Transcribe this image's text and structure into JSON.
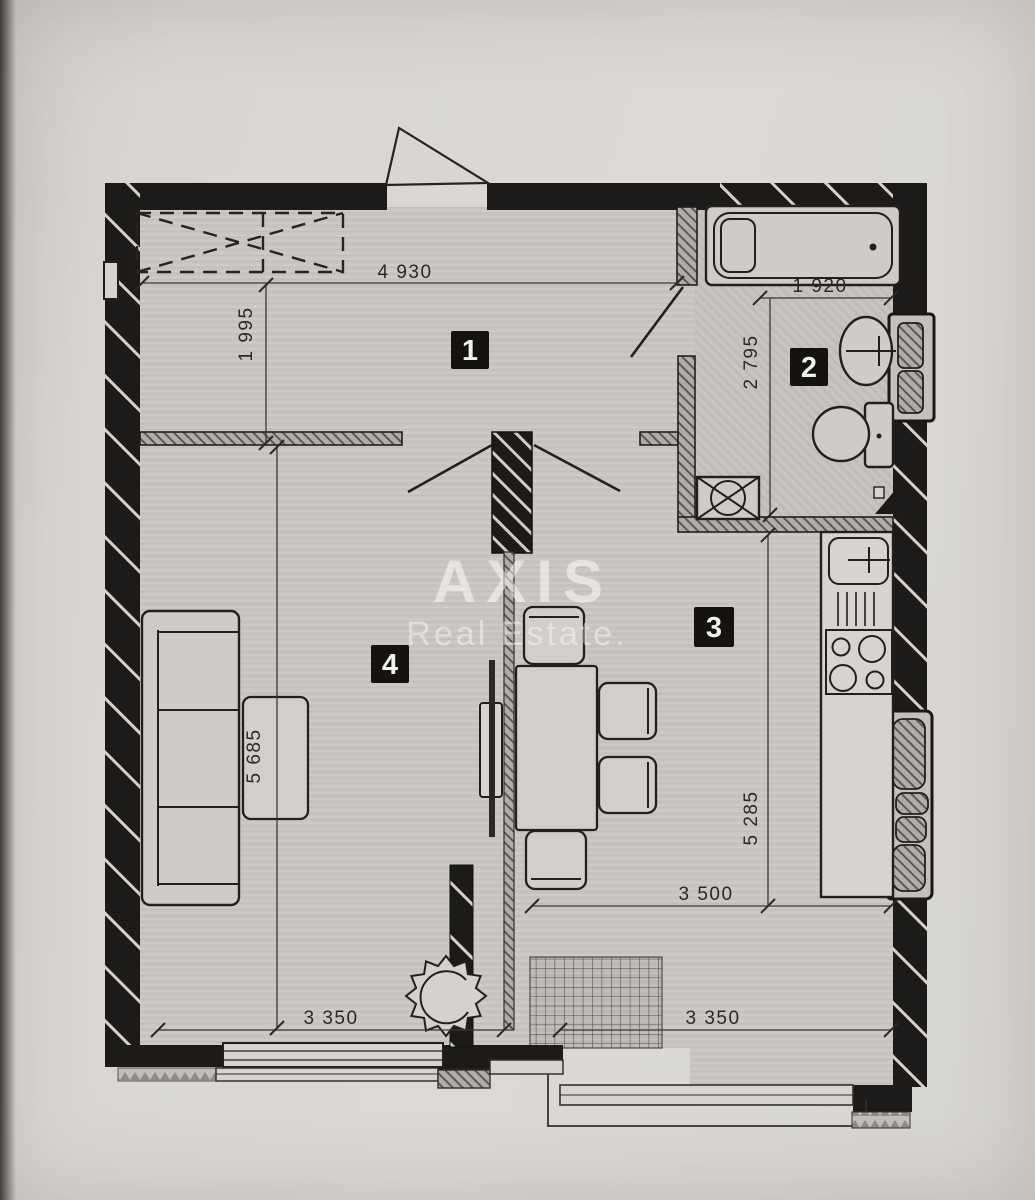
{
  "document": {
    "kind": "apartment floor plan photo"
  },
  "watermark": {
    "title": "AXIS",
    "subtitle": "Real Estate."
  },
  "rooms": [
    {
      "label": "1"
    },
    {
      "label": "2"
    },
    {
      "label": "3"
    },
    {
      "label": "4"
    }
  ],
  "dims": {
    "hall_width_top": "4 930",
    "hall_depth_left": "1 995",
    "bath_width_top": "1 920",
    "bath_depth_left": "2 795",
    "kitchen_depth_right": "5 285",
    "kitchen_width_bottom": "3 500",
    "living_depth_left": "5 685",
    "living_width_bottom": "3 350",
    "kitchen_width_lower": "3 350"
  },
  "colors": {
    "paper": "#d8d5d1",
    "wall": "#1d1b19",
    "floor": "#c8c5c0",
    "label_bg": "#151312",
    "label_fg": "#f2f0ed"
  }
}
